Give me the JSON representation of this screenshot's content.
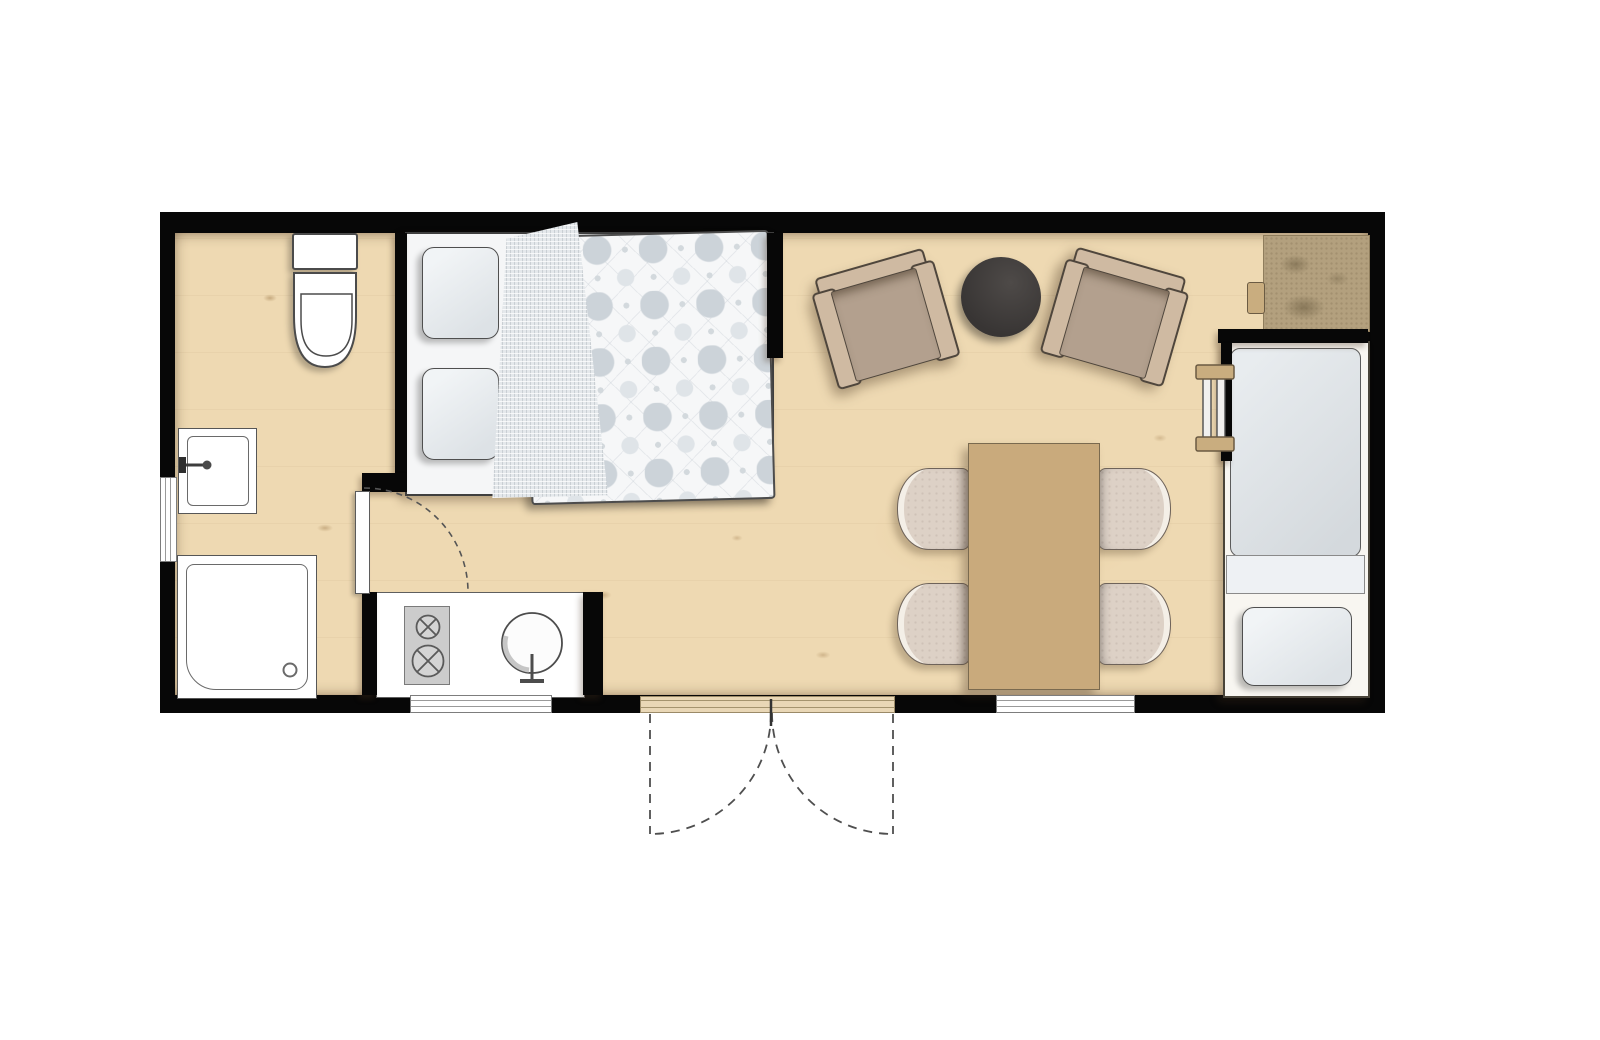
{
  "meta": {
    "kind": "architectural-floor-plan",
    "description": "Top-down floor plan of a small studio holiday lodge, no text labels visible",
    "visible_text_items": []
  },
  "theme": {
    "canvas_bg": "#ffffff",
    "wall": "#070707",
    "floor": "#eed9b2",
    "outline": "#4a4a4a",
    "fixture_white": "#ffffff",
    "linen_white": "#f5f6f7",
    "pillow_fill": "#e7ebee",
    "blanket_fill": "#e4e8eb",
    "duvet_base": "#f6f7f8",
    "duvet_dot": "#ccd3d9",
    "mattress_fill": "#dbdfe3",
    "armchair_frame": "#cfbaa2",
    "armchair_seat": "#b3a08e",
    "coffee_table": "#403d3b",
    "dining_table": "#c9aa7c",
    "chair_fill": "#ddd1c6",
    "chair_edge": "#f4efe7",
    "counter_brown": "#b3a07e",
    "appliance_gray": "#cccccc",
    "wood_sill": "#e9d7b6",
    "dash_line": "#4f4f4f"
  },
  "plan": {
    "rooms": [
      {
        "id": "bathroom",
        "features": [
          "toilet",
          "washbasin-with-faucet",
          "shower-tray-with-drain",
          "west-window",
          "hinged-door-with-swing-arc"
        ]
      },
      {
        "id": "sleeping-alcove",
        "features": [
          "double-bed",
          "two-pillows",
          "folded-checked-blanket",
          "patterned-duvet"
        ]
      },
      {
        "id": "living-dining-area",
        "features": [
          "two-angled-armchairs",
          "round-dark-coffee-table",
          "rectangular-dining-table",
          "four-dining-chairs"
        ]
      },
      {
        "id": "kitchenette",
        "features": [
          "white-counter",
          "two-burner-hob",
          "round-sink-with-tap",
          "south-window"
        ]
      },
      {
        "id": "single-bed-nook",
        "features": [
          "single-bed",
          "mattress",
          "sheet-band",
          "pillow",
          "ladder",
          "brown-side-counter"
        ]
      }
    ],
    "openings": {
      "entrance": "double-french-doors-south-with-dashed-swing-arcs",
      "interior_door": "bathroom-door-dashed-quarter-arc",
      "windows": [
        "west-wall-window",
        "south-kitchen-window",
        "south-dining-window"
      ]
    }
  }
}
